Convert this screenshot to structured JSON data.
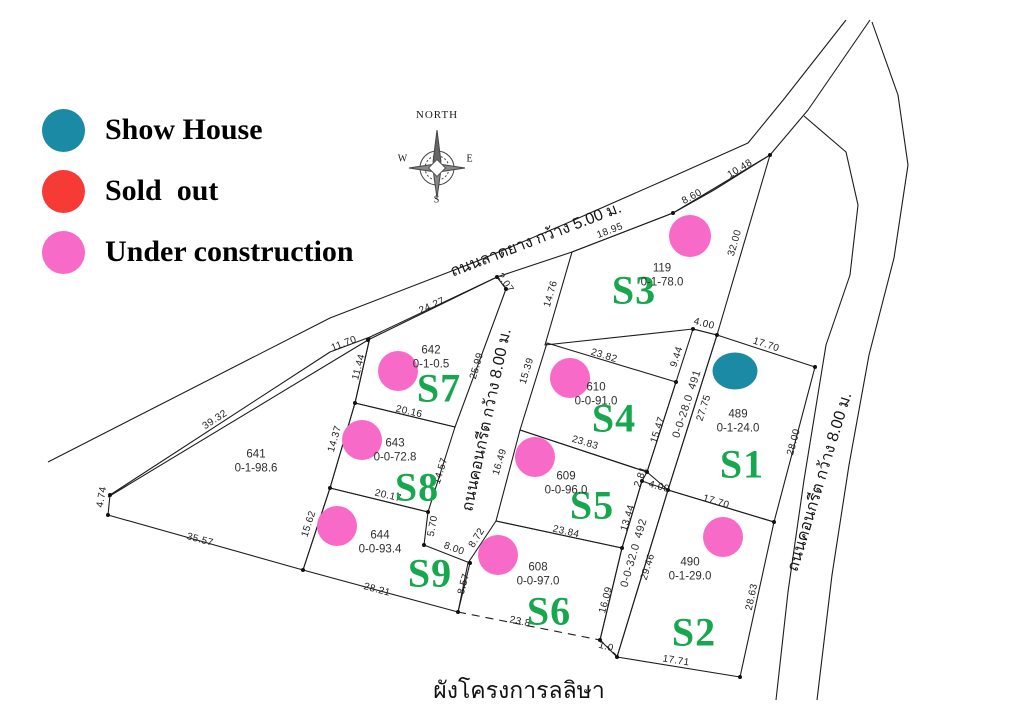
{
  "title": "ผังโครงการลลิษา",
  "status_colors": {
    "show-house": "#1b8aa4",
    "sold-out": "#f63b36",
    "under-construction": "#f76ac8"
  },
  "legend": {
    "items": [
      {
        "label": "Show House",
        "status": "show-house"
      },
      {
        "label": "Sold  out",
        "status": "sold-out"
      },
      {
        "label": "Under construction",
        "status": "under-construction"
      }
    ]
  },
  "compass": {
    "north": "NORTH",
    "west": "W",
    "east": "E",
    "south": "S"
  },
  "map": {
    "roads": [
      {
        "name": "ถนนลาดยาง กว้าง 5.00 ม.",
        "x": 536,
        "y": 240,
        "rot": -21
      },
      {
        "name": "ถนนคอนกรีต กว้าง 8.00 ม.",
        "x": 487,
        "y": 420,
        "rot": -78
      },
      {
        "name": "ถนนคอนกรีต กว้าง 8.00 ม.",
        "x": 820,
        "y": 482,
        "rot": -73
      }
    ],
    "strips": [
      {
        "parcel": "491",
        "area": "0-0-28.0",
        "x": 687,
        "y": 404,
        "rot": -72
      },
      {
        "parcel": "492",
        "area": "0-0-32.0",
        "x": 634,
        "y": 553,
        "rot": -74
      }
    ],
    "plots": [
      {
        "id": "S3",
        "parcel": "119",
        "area": "0-1-78.0",
        "status": "under-construction",
        "id_label": {
          "x": 634,
          "y": 290
        },
        "parcel_label": {
          "x": 662,
          "y": 276
        },
        "marker": {
          "x": 690,
          "y": 236,
          "w": 42,
          "h": 42
        }
      },
      {
        "id": "S7",
        "parcel": "642",
        "area": "0-1-0.5",
        "status": "under-construction",
        "id_label": {
          "x": 439,
          "y": 388
        },
        "parcel_label": {
          "x": 431,
          "y": 358
        },
        "marker": {
          "x": 398,
          "y": 371,
          "w": 40,
          "h": 40
        }
      },
      {
        "id": "S8",
        "parcel": "643",
        "area": "0-0-72.8",
        "status": "under-construction",
        "id_label": {
          "x": 417,
          "y": 487
        },
        "parcel_label": {
          "x": 395,
          "y": 451
        },
        "marker": {
          "x": 362,
          "y": 440,
          "w": 40,
          "h": 40
        }
      },
      {
        "id": "S9",
        "parcel": "644",
        "area": "0-0-93.4",
        "status": "under-construction",
        "id_label": {
          "x": 430,
          "y": 573
        },
        "parcel_label": {
          "x": 380,
          "y": 543
        },
        "marker": {
          "x": 337,
          "y": 526,
          "w": 40,
          "h": 40
        }
      },
      {
        "id": "S4",
        "parcel": "610",
        "area": "0-0-91.0",
        "status": "under-construction",
        "id_label": {
          "x": 614,
          "y": 418
        },
        "parcel_label": {
          "x": 596,
          "y": 395
        },
        "marker": {
          "x": 570,
          "y": 378,
          "w": 40,
          "h": 40
        }
      },
      {
        "id": "S5",
        "parcel": "609",
        "area": "0-0-96.0",
        "status": "under-construction",
        "id_label": {
          "x": 592,
          "y": 505
        },
        "parcel_label": {
          "x": 566,
          "y": 484
        },
        "marker": {
          "x": 535,
          "y": 457,
          "w": 40,
          "h": 40
        }
      },
      {
        "id": "S6",
        "parcel": "608",
        "area": "0-0-97.0",
        "status": "under-construction",
        "id_label": {
          "x": 549,
          "y": 611
        },
        "parcel_label": {
          "x": 538,
          "y": 575
        },
        "marker": {
          "x": 498,
          "y": 555,
          "w": 40,
          "h": 40
        }
      },
      {
        "id": "S1",
        "parcel": "489",
        "area": "0-1-24.0",
        "status": "show-house",
        "id_label": {
          "x": 742,
          "y": 464
        },
        "parcel_label": {
          "x": 738,
          "y": 422
        },
        "marker": {
          "x": 735,
          "y": 371,
          "w": 45,
          "h": 37
        }
      },
      {
        "id": "S2",
        "parcel": "490",
        "area": "0-1-29.0",
        "status": "under-construction",
        "id_label": {
          "x": 694,
          "y": 632
        },
        "parcel_label": {
          "x": 690,
          "y": 570
        },
        "marker": {
          "x": 723,
          "y": 537,
          "w": 40,
          "h": 40
        }
      },
      {
        "id": "",
        "parcel": "641",
        "area": "0-1-98.6",
        "status": "",
        "parcel_label": {
          "x": 256,
          "y": 462
        }
      }
    ],
    "dimensions": [
      {
        "text": "18.95",
        "x": 610,
        "y": 231,
        "rot": -21
      },
      {
        "text": "8.60",
        "x": 692,
        "y": 197,
        "rot": -29
      },
      {
        "text": "10.48",
        "x": 740,
        "y": 169,
        "rot": -31
      },
      {
        "text": "32.00",
        "x": 735,
        "y": 243,
        "rot": -74
      },
      {
        "text": "24.27",
        "x": 432,
        "y": 306,
        "rot": -24
      },
      {
        "text": "2.07",
        "x": 505,
        "y": 283,
        "rot": 55
      },
      {
        "text": "14.76",
        "x": 551,
        "y": 294,
        "rot": -74
      },
      {
        "text": "4.00",
        "x": 704,
        "y": 324,
        "rot": 14
      },
      {
        "text": "9.44",
        "x": 677,
        "y": 357,
        "rot": -72
      },
      {
        "text": "17.70",
        "x": 766,
        "y": 345,
        "rot": 18
      },
      {
        "text": "15.47",
        "x": 658,
        "y": 430,
        "rot": -72
      },
      {
        "text": "27.75",
        "x": 704,
        "y": 408,
        "rot": -72
      },
      {
        "text": "28.00",
        "x": 794,
        "y": 442,
        "rot": -75
      },
      {
        "text": "23.82",
        "x": 604,
        "y": 356,
        "rot": 17
      },
      {
        "text": "15.39",
        "x": 527,
        "y": 371,
        "rot": -73
      },
      {
        "text": "23.83",
        "x": 585,
        "y": 443,
        "rot": 17
      },
      {
        "text": "16.49",
        "x": 500,
        "y": 462,
        "rot": -73
      },
      {
        "text": "23.84",
        "x": 566,
        "y": 532,
        "rot": 13
      },
      {
        "text": "2.81",
        "x": 641,
        "y": 477,
        "rot": -70
      },
      {
        "text": "4.00",
        "x": 659,
        "y": 487,
        "rot": 15
      },
      {
        "text": "13.44",
        "x": 628,
        "y": 518,
        "rot": -73
      },
      {
        "text": "29.46",
        "x": 648,
        "y": 567,
        "rot": -73
      },
      {
        "text": "16.09",
        "x": 606,
        "y": 600,
        "rot": -75
      },
      {
        "text": "1.0",
        "x": 606,
        "y": 647,
        "rot": 15
      },
      {
        "text": "17.70",
        "x": 716,
        "y": 502,
        "rot": 17
      },
      {
        "text": "28.63",
        "x": 752,
        "y": 597,
        "rot": -78
      },
      {
        "text": "17.71",
        "x": 676,
        "y": 661,
        "rot": 9
      },
      {
        "text": "8.72",
        "x": 477,
        "y": 538,
        "rot": -58
      },
      {
        "text": "8.57",
        "x": 464,
        "y": 584,
        "rot": -75
      },
      {
        "text": "23.8",
        "x": 520,
        "y": 622,
        "rot": 12
      },
      {
        "text": "25.99",
        "x": 477,
        "y": 366,
        "rot": -74
      },
      {
        "text": "20.16",
        "x": 409,
        "y": 412,
        "rot": 13
      },
      {
        "text": "14.57",
        "x": 441,
        "y": 471,
        "rot": -73
      },
      {
        "text": "20.17",
        "x": 388,
        "y": 496,
        "rot": 13
      },
      {
        "text": "5.70",
        "x": 433,
        "y": 526,
        "rot": -80
      },
      {
        "text": "8.00",
        "x": 454,
        "y": 549,
        "rot": 20
      },
      {
        "text": "28.21",
        "x": 377,
        "y": 590,
        "rot": 15
      },
      {
        "text": "15.62",
        "x": 309,
        "y": 524,
        "rot": -72
      },
      {
        "text": "14.37",
        "x": 335,
        "y": 439,
        "rot": -74
      },
      {
        "text": "11.44",
        "x": 359,
        "y": 367,
        "rot": -75
      },
      {
        "text": "11.70",
        "x": 344,
        "y": 344,
        "rot": -21
      },
      {
        "text": "39.32",
        "x": 215,
        "y": 420,
        "rot": -33
      },
      {
        "text": "4.74",
        "x": 102,
        "y": 497,
        "rot": -80
      },
      {
        "text": "35.57",
        "x": 200,
        "y": 540,
        "rot": 15
      }
    ]
  }
}
